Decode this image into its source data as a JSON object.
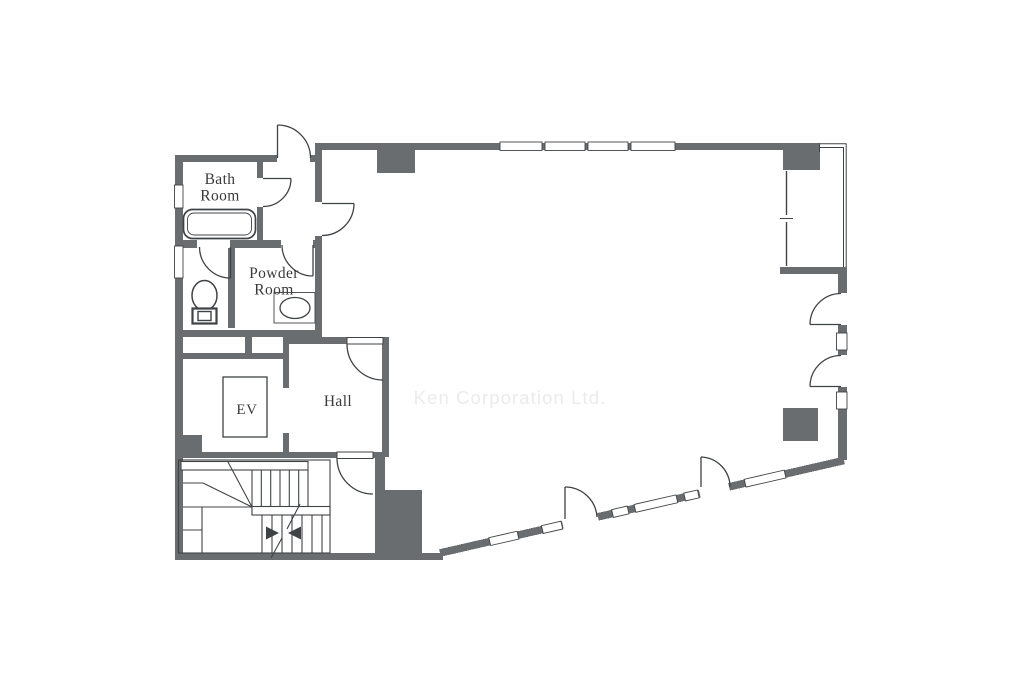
{
  "watermark": "Ken Corporation Ltd.",
  "rooms": {
    "bath": {
      "line1": "Bath",
      "line2": "Room"
    },
    "powder": {
      "line1": "Powder",
      "line2": "Room"
    },
    "ev": "EV",
    "hall": "Hall"
  },
  "colors": {
    "background": "#ffffff",
    "wall": "#6a6d6f",
    "line": "#3f4345",
    "text": "#3a3a3a",
    "watermark": "#ebebeb"
  },
  "fixtures": [
    "bathtub-icon",
    "toilet-icon",
    "washbasin-icon",
    "elevator-shaft",
    "staircase-icon",
    "stair-direction-arrows",
    "door-swing-arcs",
    "window-segments",
    "balcony-window"
  ]
}
